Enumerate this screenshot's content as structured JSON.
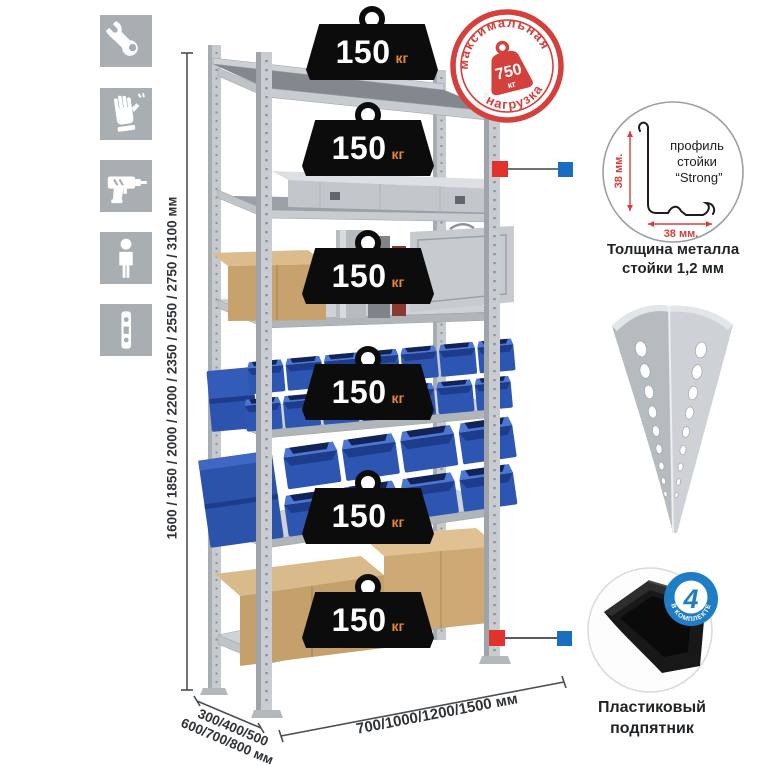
{
  "legend_icons": [
    "wrench-icon",
    "gloves-icon",
    "drill-icon",
    "person-icon",
    "upright-strip-icon"
  ],
  "stamp": {
    "arc_top": "максимальная",
    "arc_bottom": "нагрузка",
    "weight": "750",
    "unit": "кг"
  },
  "badge": {
    "value": "150",
    "unit": "кг"
  },
  "dimensions": {
    "height": "1600 / 1850 / 2000 / 2200 / 2350 / 2550 / 2750 / 3100 мм",
    "width": "700/1000/1200/1500 мм",
    "depth_line1": "300/400/500",
    "depth_line2": "600/700/800 мм"
  },
  "profile": {
    "label_line1": "профиль",
    "label_line2": "стойки",
    "label_line3": "“Strong”",
    "dim_v": "38 мм.",
    "dim_h": "38 мм.",
    "caption1": "Толщина металла",
    "caption2": "стойки 1,2 мм"
  },
  "foot": {
    "badge_number": "4",
    "badge_label": "в комплекте",
    "caption1": "Пластиковый",
    "caption2": "подпятник"
  },
  "colors": {
    "accent_red": "#d4403c",
    "marker_red": "#e3322b",
    "marker_blue": "#1a6ec1",
    "badge_blue": "#1f7dc5",
    "bin_blue": "#2d56b2",
    "icon_gray": "#a9aeb3"
  }
}
